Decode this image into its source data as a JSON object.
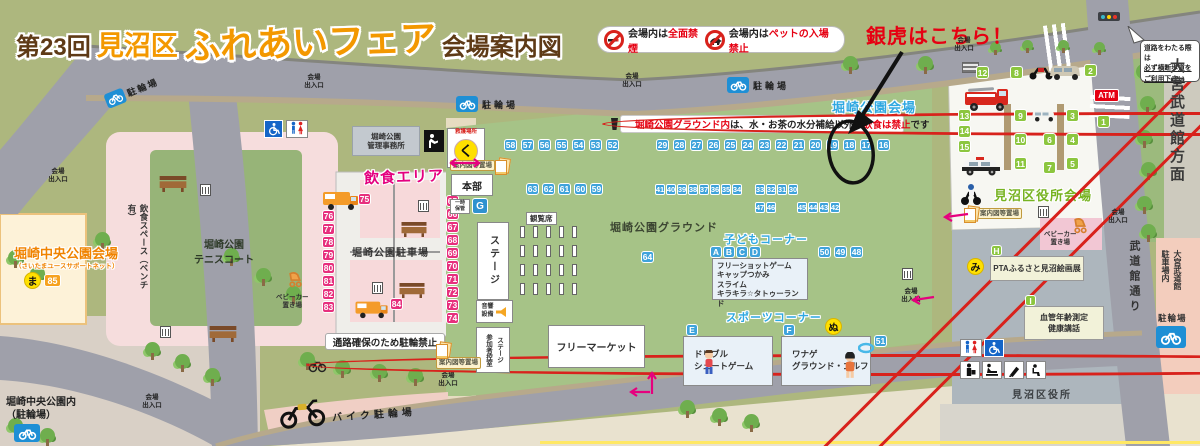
{
  "title": {
    "p1": "第23回",
    "p2": "見沼区",
    "p3": "ふれあいフェア",
    "p4": "会場案内図"
  },
  "annotation": {
    "gintora": "銀虎はこちら！"
  },
  "notices": {
    "smoke_prefix": "会場内は",
    "smoke_red": "全面禁煙",
    "pets_prefix": "会場内は",
    "pets_red": "ペットの入場禁止",
    "rule_r1": "堀崎公園グラウンド内",
    "rule_b1": "は、水・お茶の水分補給以外の",
    "rule_r2": "飲食は禁止",
    "rule_b2": "です",
    "path_bike": "通路確保のため駐輪禁止",
    "cross_l1": "道路をわたる際は",
    "cross_l2": "必ず横断歩道を",
    "cross_l3": "ご利用下さい"
  },
  "venues": {
    "park": "堀崎公園会場",
    "central": "堀崎中央公園会場",
    "central_sub": "（さいたまユースサポートネット）",
    "ward": "見沼区役所会場"
  },
  "labels": {
    "food_area": "飲食エリア",
    "ground": "堀崎公園グラウンド",
    "parking_lot": "堀崎公園駐車場",
    "tennis_l1": "堀崎公園",
    "tennis_l2": "テニスコート",
    "eat_space": "飲食スペース（ベンチ有）",
    "kids": "子どもコーナー",
    "sports": "スポーツコーナー",
    "flea": "フリーマーケット",
    "moto_parking": "バイク駐輪場",
    "bicycle": "駐輪場",
    "central_l1": "堀崎中央公園内",
    "central_l2": "（駐輪場）",
    "ward_office": "見沼区役所",
    "street": "武道館通り",
    "budokan_dir": "大宮武道館方面",
    "budokan_park_l1": "大宮武道館",
    "budokan_park_l2": "駐車場内",
    "stage": "ステージ",
    "hq": "本部",
    "aid": "救護場所",
    "aid_mark": "く",
    "storage_l1": "一時",
    "storage_l2": "保管",
    "audience": "観覧席",
    "sound_l1": "音響",
    "sound_l2": "設備",
    "waiting_l1": "ステージ",
    "waiting_l2": "参加者控室",
    "map_stand": "案内図等置場",
    "office_l1": "堀崎公園",
    "office_l2": "管理事務所",
    "stroller_l1": "ベビーカー",
    "stroller_l2": "置き場",
    "gate_l1": "会場",
    "gate_l2": "出入口",
    "atm": "ATM",
    "pta": "PTAふるさと見沼絵画展",
    "health_l1": "血管年齢測定",
    "health_l2": "健康講話"
  },
  "kids_items": [
    "フリーショットゲーム",
    "キャップつかみ",
    "スライム",
    "キラキラ☆タトゥーランド"
  ],
  "sports_e": [
    "ドリブル",
    "シュートゲーム"
  ],
  "sports_f": [
    "ワナゲ",
    "グラウンド・ゴルフ"
  ],
  "booths": {
    "r58": [
      "58",
      "57",
      "56",
      "55",
      "54",
      "53",
      "52"
    ],
    "r29": [
      "29",
      "28",
      "27",
      "26",
      "25",
      "24",
      "23",
      "22",
      "21",
      "20",
      "19",
      "18",
      "17",
      "16"
    ],
    "r63": [
      "63",
      "62",
      "61",
      "60",
      "59"
    ],
    "r41": [
      "41",
      "40",
      "39",
      "38",
      "37",
      "36",
      "35",
      "34"
    ],
    "r33": [
      "33",
      "32",
      "31",
      "30"
    ],
    "r47": [
      "47",
      "46"
    ],
    "r45": [
      "45",
      "44",
      "43",
      "42"
    ],
    "r50": [
      "50",
      "49",
      "48"
    ],
    "n64": "64",
    "n51": "51",
    "pinkL": [
      "76",
      "77",
      "78",
      "79",
      "80",
      "81",
      "82",
      "83"
    ],
    "pinkR": [
      "65",
      "66",
      "67",
      "68",
      "69",
      "70",
      "71",
      "72",
      "73",
      "74"
    ],
    "p75": "75",
    "p84": "84",
    "n85": "85",
    "g12": "12",
    "g8": "8",
    "g2": "2",
    "g1": "1",
    "colL": [
      "13",
      "14",
      "15"
    ],
    "colM": [
      "9",
      "10",
      "11"
    ],
    "colN": [
      "6",
      "7"
    ],
    "colR": [
      "3",
      "4",
      "5"
    ]
  },
  "letters": {
    "a": "A",
    "b": "B",
    "c": "C",
    "d": "D",
    "e": "E",
    "f": "F",
    "g": "G",
    "h": "H",
    "i": "I"
  },
  "markers": {
    "ma": "ま",
    "mi": "み",
    "nu": "ぬ"
  }
}
